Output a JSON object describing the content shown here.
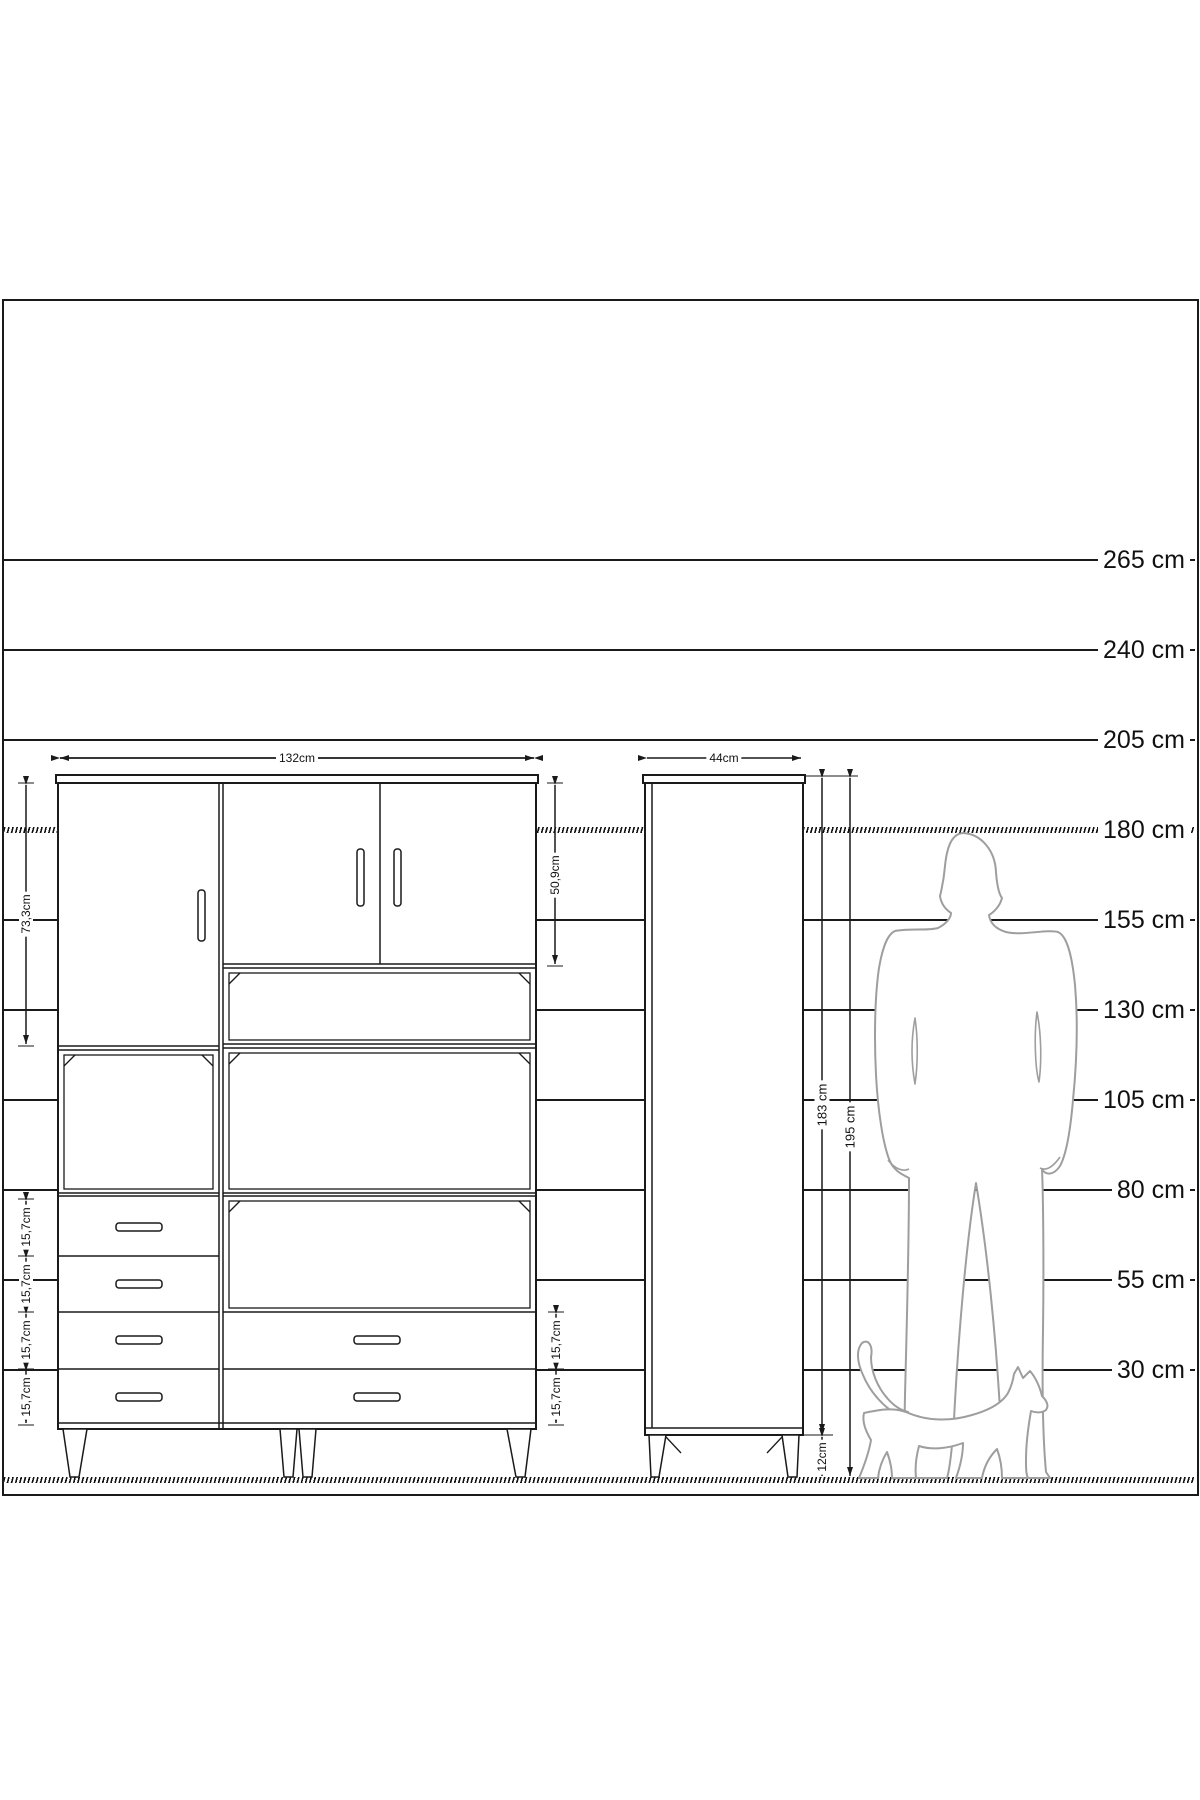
{
  "height_scale": {
    "unit": "cm",
    "labels": [
      "265 cm",
      "240 cm",
      "205 cm",
      "180 cm",
      "155 cm",
      "130 cm",
      "105 cm",
      "80 cm",
      "55 cm",
      "30 cm"
    ]
  },
  "wardrobe": {
    "width_label": "132cm",
    "left_door_height_label": "73,3cm",
    "right_doors_height_label": "50,9cm",
    "left_drawer_labels": [
      "15,7cm",
      "15,7cm",
      "15,7cm",
      "15,7cm"
    ],
    "right_drawer_labels": [
      "15,7cm",
      "15,7cm"
    ]
  },
  "tall_cabinet": {
    "width_label": "44cm",
    "body_height_label": "183 cm",
    "total_height_label": "195 cm",
    "leg_height_label": "12cm"
  },
  "colors": {
    "line": "#1a1a1a",
    "silhouette": "#9e9e9e",
    "background": "#ffffff"
  }
}
